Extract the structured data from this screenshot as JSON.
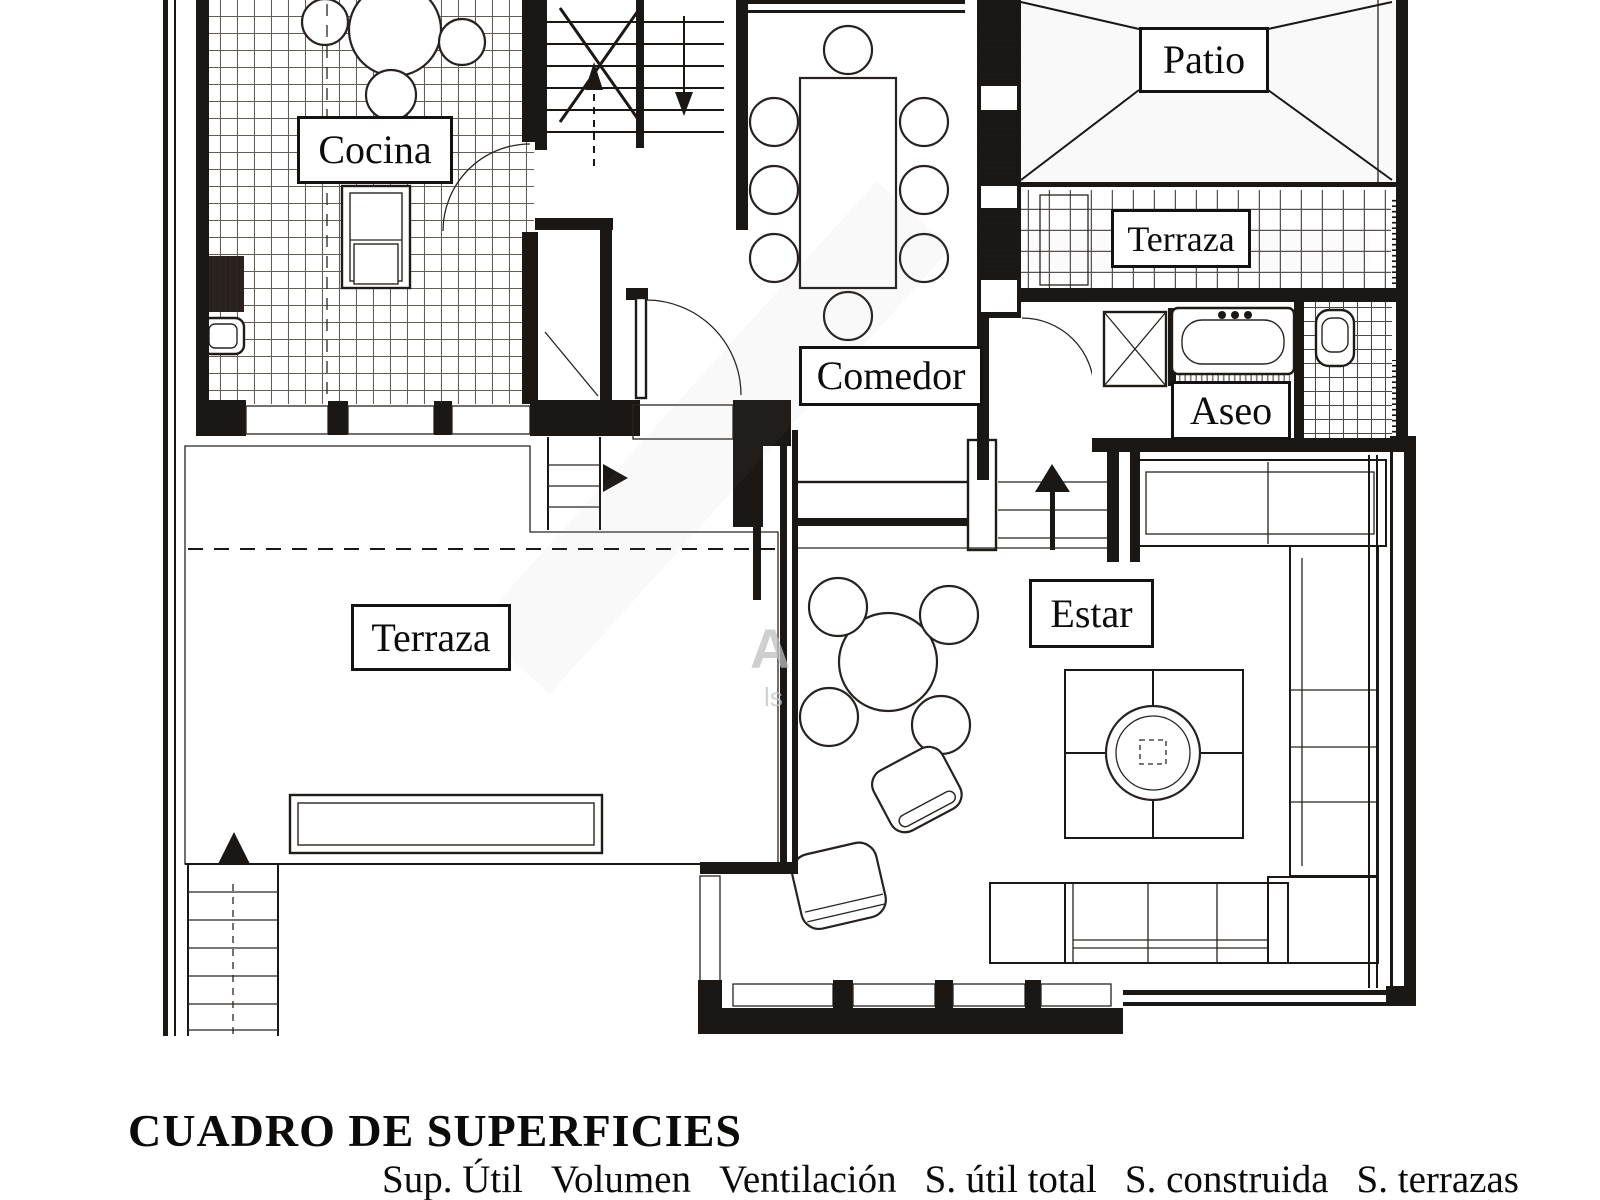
{
  "page": {
    "background": "#ffffff",
    "ink": "#1a1714"
  },
  "floor_plan": {
    "room_labels": [
      {
        "id": "cocina",
        "label": "Cocina"
      },
      {
        "id": "patio",
        "label": "Patio"
      },
      {
        "id": "terraza_upper",
        "label": "Terraza"
      },
      {
        "id": "comedor",
        "label": "Comedor"
      },
      {
        "id": "aseo",
        "label": "Aseo"
      },
      {
        "id": "estar",
        "label": "Estar"
      },
      {
        "id": "terraza_lower",
        "label": "Terraza"
      }
    ],
    "watermark_fragments": {
      "letter": "A",
      "small": "ls"
    }
  },
  "surface_table": {
    "title": "CUADRO DE SUPERFICIES",
    "columns": [
      "Sup. Útil",
      "Volumen",
      "Ventilación",
      "S. útil total",
      "S. construida",
      "S. terrazas"
    ]
  }
}
